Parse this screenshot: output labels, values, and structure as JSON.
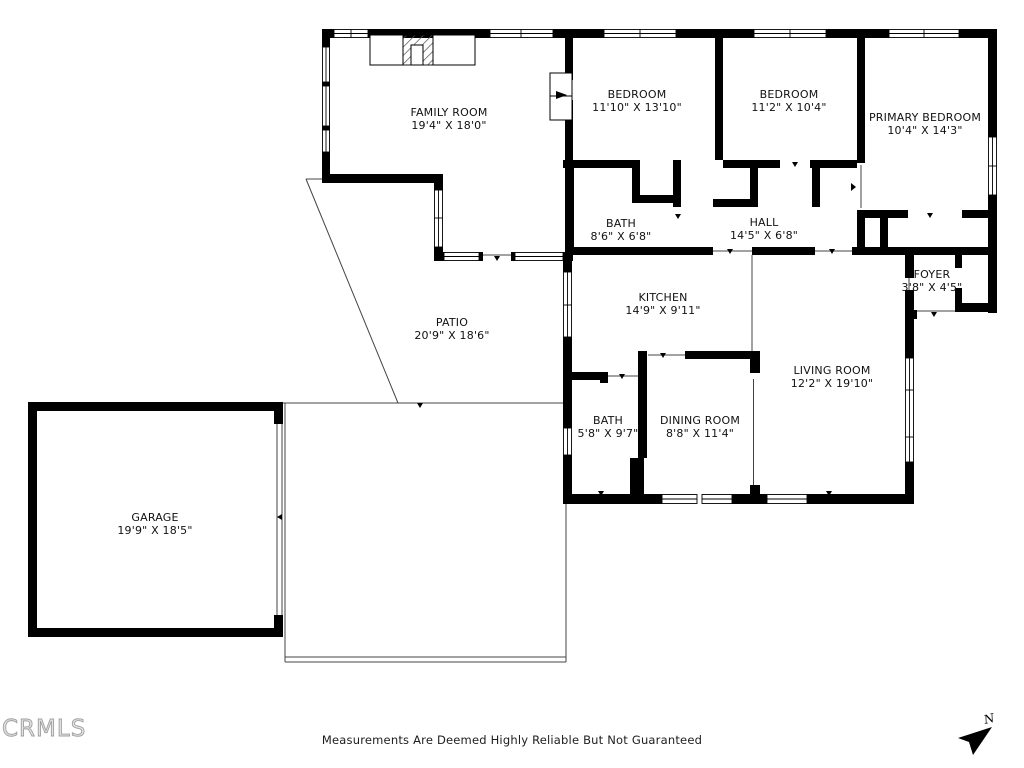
{
  "rooms": [
    {
      "name": "FAMILY ROOM",
      "dims": "19'4\" X 18'0\""
    },
    {
      "name": "BEDROOM",
      "dims": "11'10\" X 13'10\""
    },
    {
      "name": "BEDROOM",
      "dims": "11'2\" X 10'4\""
    },
    {
      "name": "PRIMARY BEDROOM",
      "dims": "10'4\" X 14'3\""
    },
    {
      "name": "BATH",
      "dims": "8'6\" X 6'8\""
    },
    {
      "name": "HALL",
      "dims": "14'5\" X 6'8\""
    },
    {
      "name": "FOYER",
      "dims": "3'8\" X 4'5\""
    },
    {
      "name": "KITCHEN",
      "dims": "14'9\" X 9'11\""
    },
    {
      "name": "PATIO",
      "dims": "20'9\" X 18'6\""
    },
    {
      "name": "LIVING ROOM",
      "dims": "12'2\" X 19'10\""
    },
    {
      "name": "BATH",
      "dims": "5'8\" X 9'7\""
    },
    {
      "name": "DINING ROOM",
      "dims": "8'8\" X 11'4\""
    },
    {
      "name": "GARAGE",
      "dims": "19'9\" X 18'5\""
    }
  ],
  "footer": {
    "disclaimer": "Measurements Are Deemed Highly Reliable But Not Guaranteed",
    "watermark": "CRMLS",
    "north_label": "N"
  },
  "colors": {
    "walls": "#000000",
    "background": "#ffffff",
    "label_text": "#111111",
    "watermark": "#9f9f9f"
  }
}
